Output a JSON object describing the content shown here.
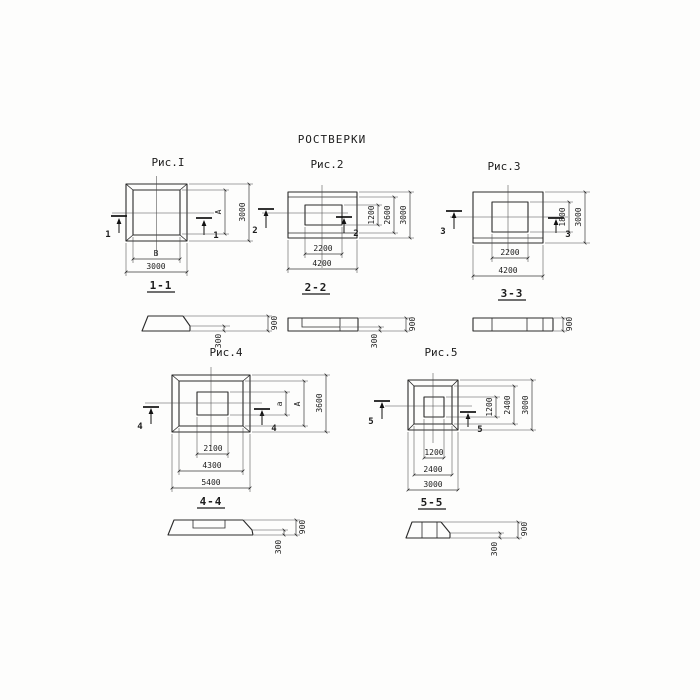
{
  "title": "РОСТВЕРКИ",
  "figures": {
    "fig1": {
      "caption": "Рис.I",
      "cut_number": "1",
      "plan": {
        "width_inner": "В",
        "width_outer": "3000",
        "height_inner": "А",
        "height_outer": "3000"
      },
      "section": {
        "label": "1-1",
        "height_total": "900",
        "height_edge": "300"
      }
    },
    "fig2": {
      "caption": "Рис.2",
      "cut_number": "2",
      "plan": {
        "width_inner": "2200",
        "width_outer": "4200",
        "height_inner": "1200",
        "height_mid": "2600",
        "height_outer": "3000"
      },
      "section": {
        "label": "2-2",
        "height_total": "900",
        "height_edge": "300"
      }
    },
    "fig3": {
      "caption": "Рис.3",
      "cut_number": "3",
      "plan": {
        "width_inner": "2200",
        "width_outer": "4200",
        "height_inner": "1800",
        "height_outer": "3000"
      },
      "section": {
        "label": "3-3",
        "height_total": "900"
      }
    },
    "fig4": {
      "caption": "Рис.4",
      "cut_number": "4",
      "plan": {
        "width_inner": "2100",
        "width_mid": "4300",
        "width_outer": "5400",
        "height_inner": "а",
        "height_mid": "А",
        "height_outer": "3600"
      },
      "section": {
        "label": "4-4",
        "height_total": "900",
        "height_edge": "300"
      }
    },
    "fig5": {
      "caption": "Рис.5",
      "cut_number": "5",
      "plan": {
        "width_inner": "1200",
        "width_mid": "2400",
        "width_outer": "3000",
        "height_inner": "1200",
        "height_mid": "2400",
        "height_outer": "3000"
      },
      "section": {
        "label": "5-5",
        "height_total": "900",
        "height_edge": "300"
      }
    }
  }
}
